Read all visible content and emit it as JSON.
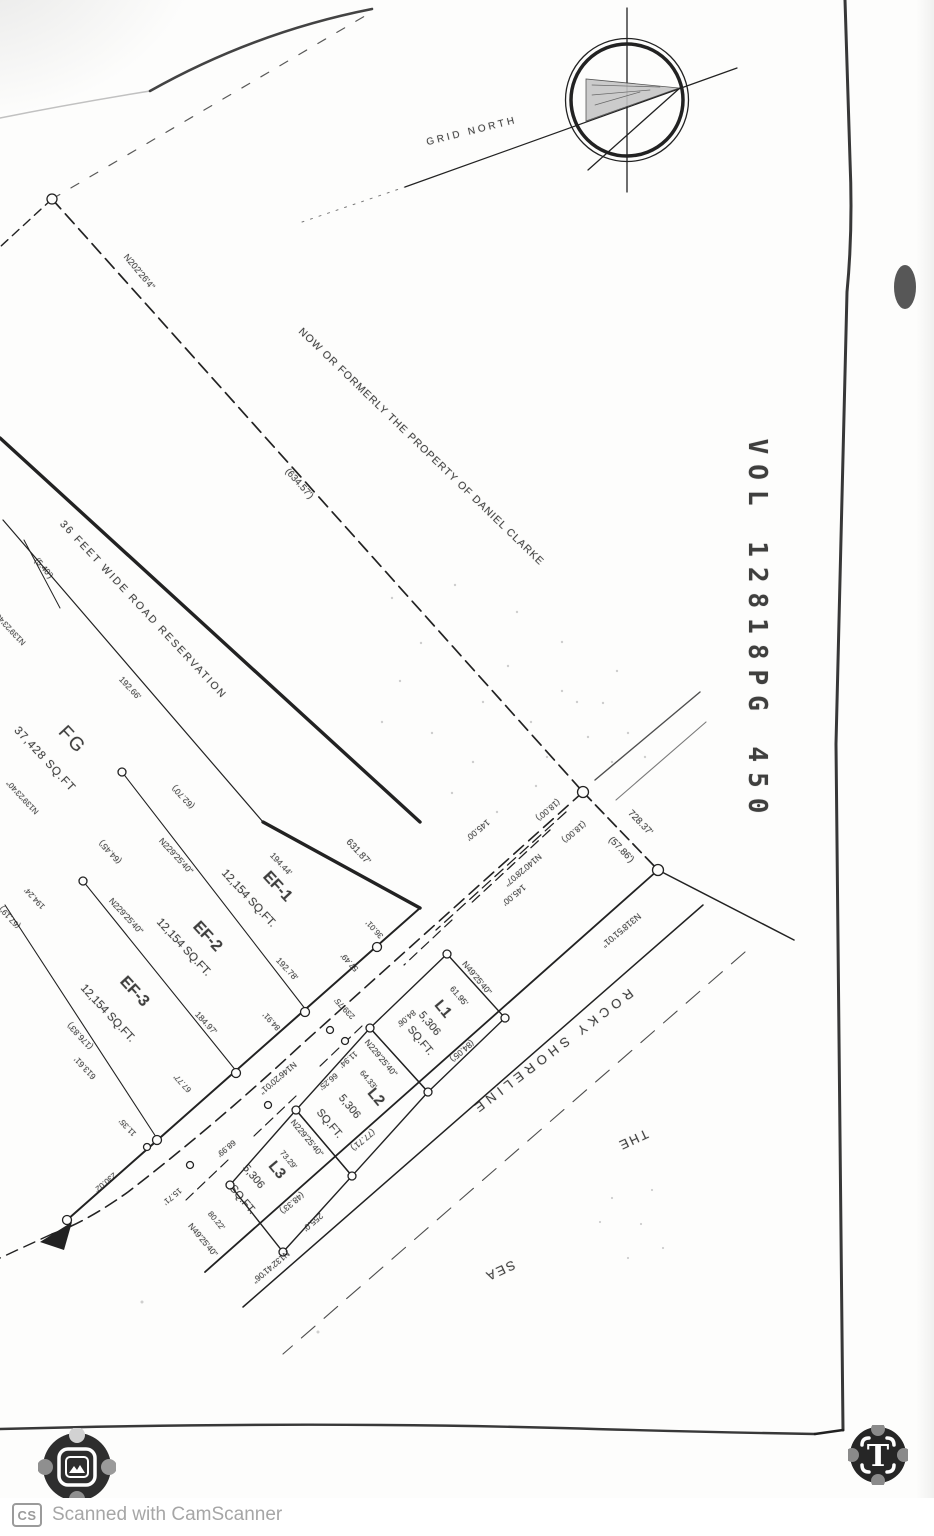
{
  "footer": {
    "cs": "CS",
    "text": "Scanned with CamScanner"
  },
  "icons": {
    "t_glyph": "T",
    "image_marker": "image-icon",
    "text_marker": "text-recognize-icon"
  },
  "map_labels": [
    {
      "t": "GRID NORTH",
      "x": 472,
      "y": 132,
      "r": -14,
      "s": 10,
      "ls": 3
    },
    {
      "t": "VOL 12818PG 450",
      "x": 757,
      "y": 631,
      "r": 90,
      "s": 26,
      "ls": 10,
      "w": 600,
      "f": "mono"
    },
    {
      "t": "NOW OR FORMERLY THE PROPERTY OF DANIEL CLARKE",
      "x": 421,
      "y": 447,
      "r": 44,
      "s": 10.5,
      "ls": 1
    },
    {
      "t": "(634.57')",
      "x": 299,
      "y": 484,
      "r": 48,
      "s": 9.5
    },
    {
      "t": "N202'26'4\"",
      "x": 139,
      "y": 272,
      "r": 50,
      "s": 9
    },
    {
      "t": "36 FEET WIDE ROAD RESERVATION",
      "x": 143,
      "y": 610,
      "r": 47,
      "s": 10.5,
      "ls": 2
    },
    {
      "t": "192.66'",
      "x": 130,
      "y": 688,
      "r": 47,
      "s": 8.5
    },
    {
      "t": "(5.40')",
      "x": 44,
      "y": 568,
      "r": 50,
      "s": 8.5
    },
    {
      "t": "N139'23'40\"",
      "x": 10,
      "y": 628,
      "r": 227,
      "s": 8
    },
    {
      "t": "N139'23'40\"",
      "x": 23,
      "y": 797,
      "r": 227,
      "s": 8
    },
    {
      "t": "FG",
      "x": 72,
      "y": 740,
      "r": 47,
      "s": 19,
      "ls": 2
    },
    {
      "t": "37,428 SQ.FT",
      "x": 44,
      "y": 760,
      "r": 47,
      "s": 11.5,
      "ls": 1
    },
    {
      "t": "(62.70')",
      "x": 183,
      "y": 797,
      "r": 227,
      "s": 8.5
    },
    {
      "t": "(64.45')",
      "x": 110,
      "y": 852,
      "r": 227,
      "s": 8.5
    },
    {
      "t": "194.24'",
      "x": 35,
      "y": 898,
      "r": 227,
      "s": 8
    },
    {
      "t": "(67.19')",
      "x": 10,
      "y": 917,
      "r": 227,
      "s": 8
    },
    {
      "t": "N229'25'40\"",
      "x": 176,
      "y": 856,
      "r": 47,
      "s": 8.5
    },
    {
      "t": "EF-1",
      "x": 277,
      "y": 887,
      "r": 47,
      "s": 16,
      "w": 700
    },
    {
      "t": "12,154 SQ.FT.",
      "x": 248,
      "y": 899,
      "r": 47,
      "s": 11.5
    },
    {
      "t": "194.44'",
      "x": 281,
      "y": 864,
      "r": 47,
      "s": 8.5
    },
    {
      "t": "631.87'",
      "x": 358,
      "y": 852,
      "r": 47,
      "s": 9.5
    },
    {
      "t": "192.78'",
      "x": 287,
      "y": 969,
      "r": 47,
      "s": 8.5
    },
    {
      "t": "EF-2",
      "x": 207,
      "y": 937,
      "r": 47,
      "s": 16,
      "w": 700
    },
    {
      "t": "12,154 SQ.FT.",
      "x": 183,
      "y": 948,
      "r": 47,
      "s": 11.5
    },
    {
      "t": "N229'25'40\"",
      "x": 126,
      "y": 916,
      "r": 47,
      "s": 8.5
    },
    {
      "t": "184.97'",
      "x": 206,
      "y": 1023,
      "r": 47,
      "s": 8.5
    },
    {
      "t": "EF-3",
      "x": 134,
      "y": 992,
      "r": 47,
      "s": 16,
      "w": 700
    },
    {
      "t": "12,154 SQ.FT.",
      "x": 107,
      "y": 1014,
      "r": 47,
      "s": 11.5
    },
    {
      "t": "(176.83')",
      "x": 80,
      "y": 1036,
      "r": 227,
      "s": 8.5
    },
    {
      "t": "613.61'",
      "x": 85,
      "y": 1068,
      "r": 227,
      "s": 8.5
    },
    {
      "t": "36.01'",
      "x": 375,
      "y": 929,
      "r": 227,
      "s": 8
    },
    {
      "t": "57.49'",
      "x": 350,
      "y": 962,
      "r": 227,
      "s": 8
    },
    {
      "t": "239.75'",
      "x": 345,
      "y": 1008,
      "r": 227,
      "s": 8
    },
    {
      "t": "84.91'",
      "x": 272,
      "y": 1021,
      "r": 227,
      "s": 8
    },
    {
      "t": "67.77'",
      "x": 183,
      "y": 1083,
      "r": 227,
      "s": 8
    },
    {
      "t": "11.35'",
      "x": 128,
      "y": 1127,
      "r": 227,
      "s": 8
    },
    {
      "t": "145.00'",
      "x": 478,
      "y": 830,
      "r": 140,
      "s": 8.5
    },
    {
      "t": "(18.00')",
      "x": 548,
      "y": 810,
      "r": 140,
      "s": 8.5
    },
    {
      "t": "(18.00')",
      "x": 574,
      "y": 832,
      "r": 140,
      "s": 8.5
    },
    {
      "t": "N140'28'07\"",
      "x": 523,
      "y": 870,
      "r": 140,
      "s": 8.5
    },
    {
      "t": "145.00'",
      "x": 514,
      "y": 895,
      "r": 140,
      "s": 8.5
    },
    {
      "t": "728.37'",
      "x": 640,
      "y": 823,
      "r": 46,
      "s": 9.5
    },
    {
      "t": "(57.86')",
      "x": 621,
      "y": 850,
      "r": 46,
      "s": 9.5
    },
    {
      "t": "N318'51'01\"",
      "x": 621,
      "y": 930,
      "r": 140,
      "s": 9
    },
    {
      "t": "N49'25'40\"",
      "x": 477,
      "y": 978,
      "r": 50,
      "s": 8.5
    },
    {
      "t": "61.95'",
      "x": 459,
      "y": 996,
      "r": 50,
      "s": 8.5
    },
    {
      "t": "84.06'",
      "x": 406,
      "y": 1018,
      "r": 140,
      "s": 8
    },
    {
      "t": "L1",
      "x": 443,
      "y": 1009,
      "r": 50,
      "s": 15,
      "w": 700
    },
    {
      "t": "5,306",
      "x": 429,
      "y": 1024,
      "r": 50,
      "s": 11
    },
    {
      "t": "SQ.FT.",
      "x": 420,
      "y": 1041,
      "r": 50,
      "s": 11
    },
    {
      "t": "(84.05')",
      "x": 462,
      "y": 1051,
      "r": 140,
      "s": 8.5
    },
    {
      "t": "N229'25'40\"",
      "x": 381,
      "y": 1058,
      "r": 50,
      "s": 8.5
    },
    {
      "t": "64.33'",
      "x": 368,
      "y": 1080,
      "r": 50,
      "s": 8
    },
    {
      "t": "11.94'",
      "x": 348,
      "y": 1059,
      "r": 140,
      "s": 8
    },
    {
      "t": "66.25'",
      "x": 328,
      "y": 1081,
      "r": 140,
      "s": 8
    },
    {
      "t": "L2",
      "x": 376,
      "y": 1097,
      "r": 50,
      "s": 15,
      "w": 700
    },
    {
      "t": "5,306",
      "x": 349,
      "y": 1107,
      "r": 50,
      "s": 11
    },
    {
      "t": "SQ.FT.",
      "x": 329,
      "y": 1124,
      "r": 50,
      "s": 11
    },
    {
      "t": "(77.71')",
      "x": 363,
      "y": 1140,
      "r": 140,
      "s": 8.5
    },
    {
      "t": "N229'25'40\"",
      "x": 307,
      "y": 1138,
      "r": 50,
      "s": 8.5
    },
    {
      "t": "73.29'",
      "x": 288,
      "y": 1160,
      "r": 50,
      "s": 8
    },
    {
      "t": "L3",
      "x": 277,
      "y": 1170,
      "r": 50,
      "s": 15,
      "w": 700
    },
    {
      "t": "5,306",
      "x": 253,
      "y": 1177,
      "r": 50,
      "s": 11
    },
    {
      "t": "SQ.FT.",
      "x": 242,
      "y": 1200,
      "r": 50,
      "s": 11
    },
    {
      "t": "80.22'",
      "x": 216,
      "y": 1221,
      "r": 50,
      "s": 8
    },
    {
      "t": "N49'25'40\"",
      "x": 203,
      "y": 1240,
      "r": 50,
      "s": 8.5
    },
    {
      "t": "15.71'",
      "x": 172,
      "y": 1196,
      "r": 140,
      "s": 8
    },
    {
      "t": "68.99'",
      "x": 226,
      "y": 1148,
      "r": 140,
      "s": 8
    },
    {
      "t": "(48.33')",
      "x": 292,
      "y": 1203,
      "r": 140,
      "s": 8.5
    },
    {
      "t": "255.0'",
      "x": 313,
      "y": 1222,
      "r": 140,
      "s": 8.5
    },
    {
      "t": "N132'41'06\"",
      "x": 271,
      "y": 1267,
      "r": 140,
      "s": 8.5
    },
    {
      "t": "N146'20'01\"",
      "x": 278,
      "y": 1078,
      "r": 140,
      "s": 8.5
    },
    {
      "t": "230.02'",
      "x": 105,
      "y": 1182,
      "r": 140,
      "s": 8
    },
    {
      "t": "ROCKY SHORELINE",
      "x": 552,
      "y": 1052,
      "r": 143,
      "s": 13,
      "ls": 5
    },
    {
      "t": "THE",
      "x": 633,
      "y": 1140,
      "r": 155,
      "s": 13,
      "ls": 2
    },
    {
      "t": "SEA",
      "x": 500,
      "y": 1271,
      "r": 155,
      "s": 13,
      "ls": 2
    }
  ]
}
